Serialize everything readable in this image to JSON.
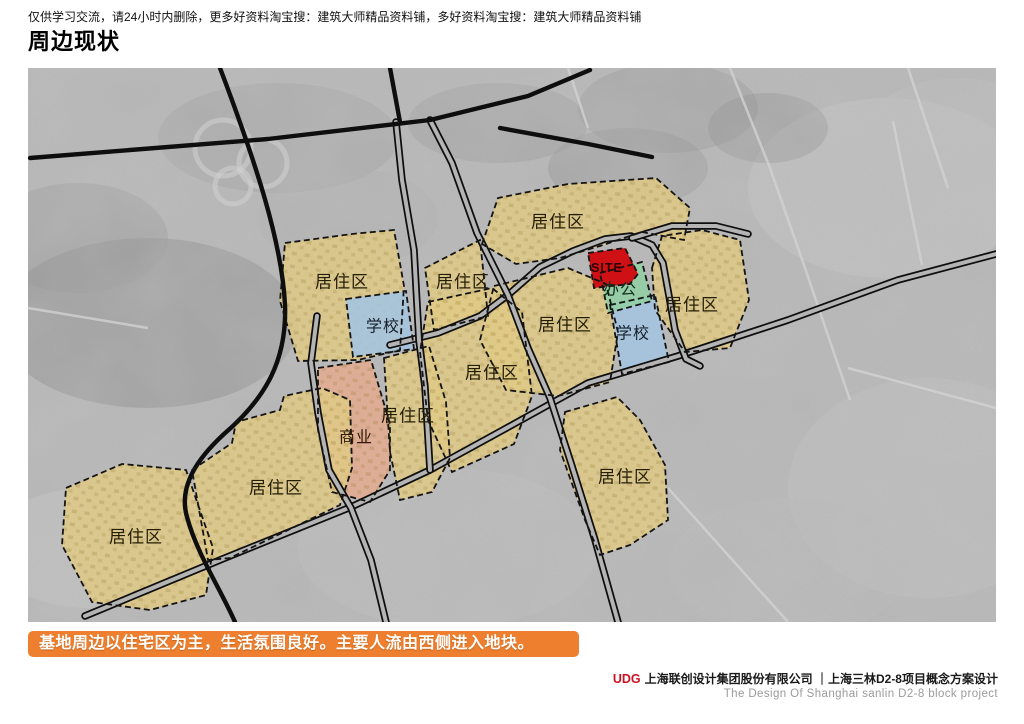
{
  "header": {
    "notice": "仅供学习交流，请24小时内删除，更多好资料淘宝搜：建筑大师精品资料铺，多好资料淘宝搜：建筑大师精品资料铺",
    "title": "周边现状"
  },
  "banner": {
    "text": "基地周边以住宅区为主，生活氛围良好。主要人流由西侧进入地块。",
    "bg": "#ed7f2e"
  },
  "footer": {
    "logo": "UDG",
    "company": "上海联创设计集团股份有限公司 ｜上海三林D2-8项目概念方案设计",
    "subtitle": "The Design Of Shanghai sanlin D2-8 block project"
  },
  "map": {
    "colors": {
      "base": "#b7b7b7",
      "minor_road": "#d2d2d2",
      "road": "#0e0e0e",
      "road_fill": "#b4b4b4",
      "outline": "#141414"
    },
    "palette": {
      "residential": "#dfc985",
      "school": "#a5c4e0",
      "office": "#92cfa5",
      "commercial": "#e3aa8e",
      "site": "#cf1115"
    },
    "legend_meaning": {
      "residential": "居住区",
      "school": "学校",
      "office": "办公",
      "commercial": "商业",
      "site": "SITE"
    },
    "patches": [
      {
        "cx": 120,
        "cy": 255,
        "rx": 150,
        "ry": 85,
        "f": "#8d8d8d",
        "o": 0.55
      },
      {
        "cx": 50,
        "cy": 170,
        "rx": 90,
        "ry": 55,
        "f": "#989898",
        "o": 0.5
      },
      {
        "cx": 250,
        "cy": 70,
        "rx": 120,
        "ry": 55,
        "f": "#a2a2a2",
        "o": 0.5
      },
      {
        "cx": 470,
        "cy": 55,
        "rx": 90,
        "ry": 40,
        "f": "#999999",
        "o": 0.45
      },
      {
        "cx": 640,
        "cy": 40,
        "rx": 90,
        "ry": 45,
        "f": "#909090",
        "o": 0.4
      },
      {
        "cx": 860,
        "cy": 120,
        "rx": 140,
        "ry": 90,
        "f": "#cacaca",
        "o": 0.5
      },
      {
        "cx": 930,
        "cy": 60,
        "rx": 90,
        "ry": 50,
        "f": "#bfbfbf",
        "o": 0.5
      },
      {
        "cx": 900,
        "cy": 420,
        "rx": 140,
        "ry": 110,
        "f": "#c6c6c6",
        "o": 0.45
      },
      {
        "cx": 760,
        "cy": 500,
        "rx": 120,
        "ry": 70,
        "f": "#bcbcbc",
        "o": 0.4
      },
      {
        "cx": 420,
        "cy": 480,
        "rx": 150,
        "ry": 80,
        "f": "#c2c2c2",
        "o": 0.35
      },
      {
        "cx": 60,
        "cy": 480,
        "rx": 100,
        "ry": 60,
        "f": "#cdcdcd",
        "o": 0.4
      },
      {
        "cx": 600,
        "cy": 100,
        "rx": 80,
        "ry": 40,
        "f": "#8a8a8a",
        "o": 0.35
      },
      {
        "cx": 320,
        "cy": 150,
        "rx": 90,
        "ry": 50,
        "f": "#adadad",
        "o": 0.4
      },
      {
        "cx": 740,
        "cy": 60,
        "rx": 60,
        "ry": 35,
        "f": "#888888",
        "o": 0.35
      }
    ],
    "interchange_loops": [
      {
        "cx": 195,
        "cy": 80,
        "r": 28
      },
      {
        "cx": 235,
        "cy": 95,
        "r": 24
      },
      {
        "cx": 205,
        "cy": 118,
        "r": 18
      }
    ],
    "roads": {
      "minor": [
        "M 702,0 L 742,100 L 777,200 L 822,332",
        "M 865,53 L 894,197",
        "M 540,0 L 560,60",
        "M 0,240 L 120,260",
        "M 640,420 L 760,554",
        "M 820,300 L 968,340",
        "M 880,0 L 920,120"
      ],
      "black": [
        "M 2,90 L 240,71 L 402,52 L 500,28 L 562,2",
        "M 472,60 L 560,76 L 624,89",
        "M 192,0 C 228,95 254,175 257,237 C 259,292 238,330 196,366 C 170,390 150,418 159,449 C 169,486 192,520 207,554",
        "M 362,0 L 372,54"
      ],
      "cased": [
        "M 57,548 L 192,492 L 323,439 L 402,402 L 475,362 L 560,315 L 650,288 L 760,252 L 870,212 L 968,186",
        "M 362,277 L 410,265 L 452,248 L 480,227 L 512,199 L 545,183 L 577,171 L 603,168 L 624,177 L 635,195 L 641,228 L 647,262 L 658,291 L 672,298",
        "M 604,170 L 644,158 L 688,158 L 720,166",
        "M 368,54 L 374,112 L 386,182 L 391,272 L 397,319 L 402,402",
        "M 402,52 L 424,95 L 449,165 L 480,227 L 500,280 L 522,330 L 543,395 L 567,472 L 590,554",
        "M 289,248 L 283,295 L 290,345 L 301,402 L 323,440 L 343,492 L 358,554"
      ]
    },
    "zones": [
      {
        "name": "residential-1",
        "type": "residential",
        "label": "居住区",
        "points": "257,175 324,166 366,162 376,218 372,282 330,292 270,293 252,233",
        "label_x": 314,
        "label_y": 214
      },
      {
        "name": "school-1",
        "type": "school",
        "label": "学校",
        "points": "318,231 378,223 386,281 325,289",
        "label_x": 355,
        "label_y": 259
      },
      {
        "name": "residential-2",
        "type": "residential",
        "label": "居住区",
        "points": "397,200 452,172 460,248 406,262",
        "label_x": 435,
        "label_y": 214
      },
      {
        "name": "residential-3",
        "type": "residential",
        "label": "居住区",
        "points": "454,176 470,130 540,116 628,110 662,140 656,172 614,164 572,178 532,190 488,196",
        "label_x": 530,
        "label_y": 154
      },
      {
        "name": "residential-4",
        "type": "residential",
        "label": "居住区",
        "points": "624,200 634,168 674,162 712,172 721,232 702,280 657,284 627,242",
        "label_x": 664,
        "label_y": 237
      },
      {
        "name": "residential-5",
        "type": "residential",
        "label": "居住区",
        "points": "466,218 540,200 578,216 590,264 582,314 530,328 478,322 452,272",
        "label_x": 537,
        "label_y": 257
      },
      {
        "name": "school-2",
        "type": "school",
        "label": "学校",
        "points": "582,237 627,227 641,294 594,306",
        "label_x": 605,
        "label_y": 266
      },
      {
        "name": "office",
        "type": "office",
        "label": "办公",
        "points": "572,205 614,194 624,233 580,245",
        "label_x": 592,
        "label_y": 222
      },
      {
        "name": "site",
        "type": "site",
        "label": "SITE",
        "points": "560,185 597,180 610,206 602,216 566,220",
        "label_x": 579,
        "label_y": 200
      },
      {
        "name": "residential-6",
        "type": "residential",
        "label": "居住区",
        "points": "400,234 464,220 494,244 504,328 486,376 424,404 400,352 392,284",
        "label_x": 464,
        "label_y": 305
      },
      {
        "name": "commercial",
        "type": "commercial",
        "label": "商业",
        "points": "290,300 343,292 362,356 362,402 342,434 304,424 290,362",
        "label_x": 328,
        "label_y": 370
      },
      {
        "name": "residential-7",
        "type": "residential",
        "label": "居住区",
        "points": "356,290 401,278 418,334 422,390 404,424 372,432 362,384",
        "label_x": 380,
        "label_y": 348
      },
      {
        "name": "residential-8",
        "type": "residential",
        "label": "居住区",
        "points": "164,402 204,375 208,354 252,342 256,328 294,320 322,332 324,400 312,437 202,490 180,492",
        "label_x": 248,
        "label_y": 420
      },
      {
        "name": "residential-9",
        "type": "residential",
        "label": "居住区",
        "points": "38,420 94,396 158,402 185,480 178,527 122,542 64,534 34,477",
        "label_x": 108,
        "label_y": 469
      },
      {
        "name": "residential-10",
        "type": "residential",
        "label": "居住区",
        "points": "537,344 589,329 612,352 637,397 640,452 602,477 572,487 557,452 532,382",
        "label_x": 597,
        "label_y": 409
      }
    ]
  }
}
